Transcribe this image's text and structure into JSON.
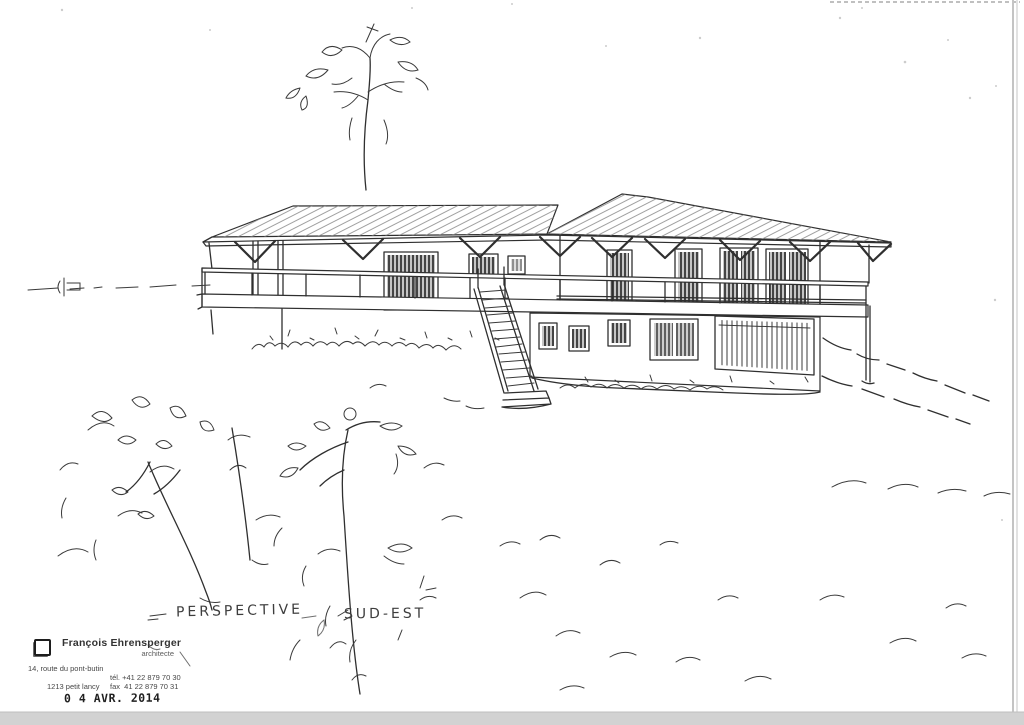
{
  "sheet": {
    "paper_color": "#ffffff",
    "ink_color": "#2f2f2f",
    "scan_band_color": "#d2d2d2"
  },
  "drawing": {
    "caption_left": "PERSPECTIVE",
    "caption_right": "SUD-EST"
  },
  "letterhead": {
    "name": "François Ehrensperger",
    "title": "architecte",
    "address_line1": "14, route du pont-butin",
    "address_line2": "1213 petit lancy",
    "tel": "tél. +41 22 879 70 30",
    "fax": "fax  41 22 879 70 31"
  },
  "date_stamp": "0 4 AVR. 2014"
}
